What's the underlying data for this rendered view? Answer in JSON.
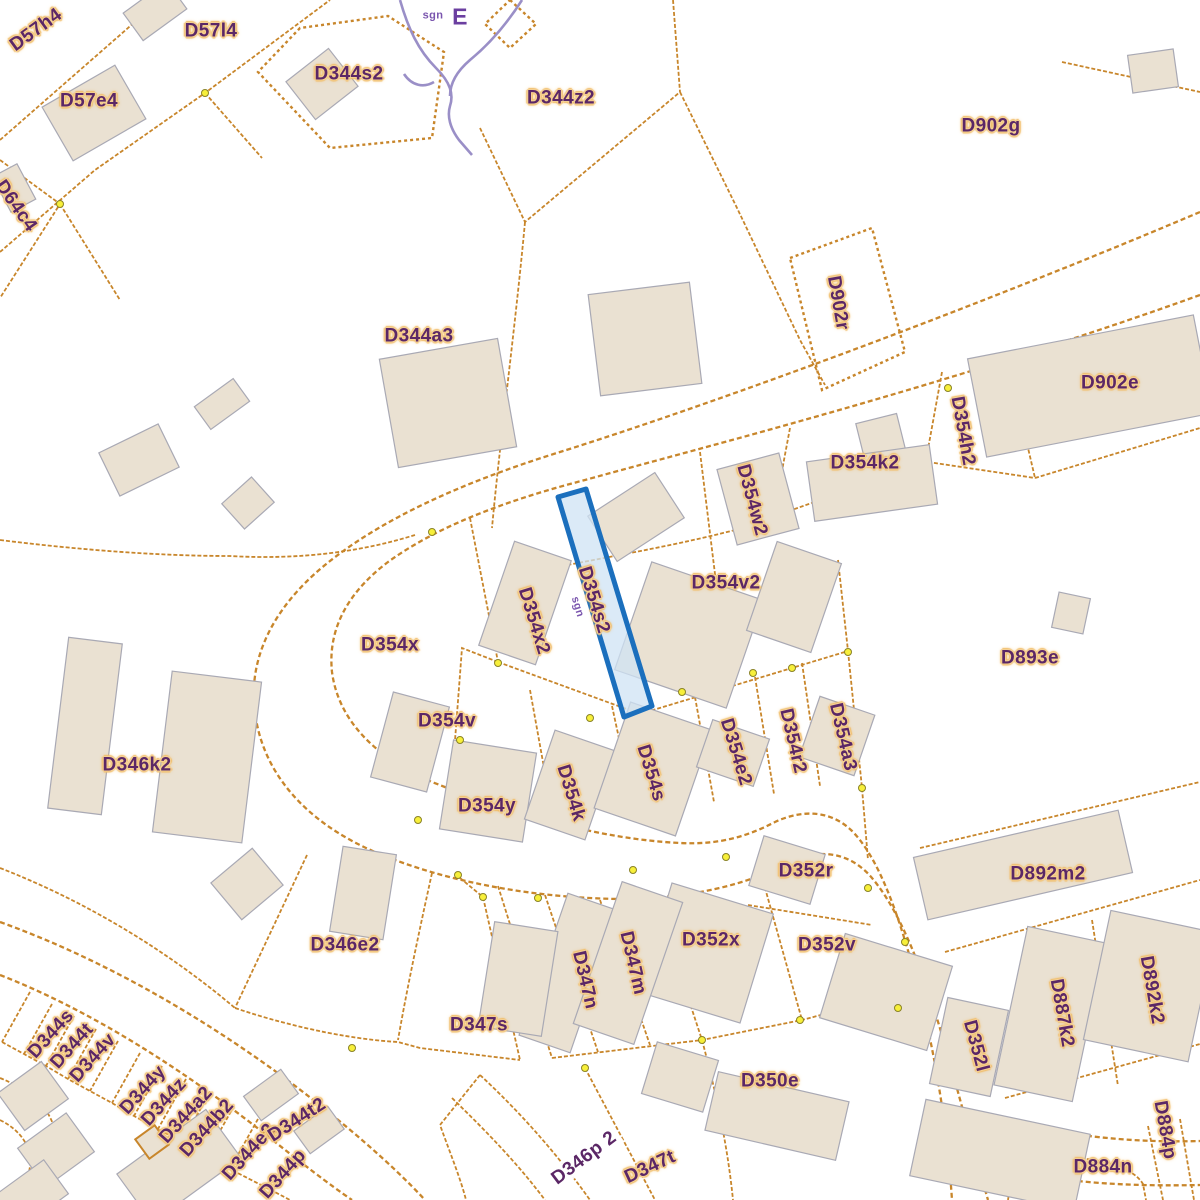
{
  "map": {
    "type": "cadastral-parcel-map",
    "highlighted_parcel": "D354s2",
    "colors": {
      "background": "#ffffff",
      "parcel_line": "#c8862b",
      "building_fill": "#eae1d2",
      "building_stroke": "#a9a9b4",
      "label_text": "#5b2766",
      "label_halo": "#f1bd68",
      "highlight_fill": "#cfe3f4",
      "highlight_stroke": "#1b6fbd",
      "stream": "#9a8fc7",
      "marker_fill": "#f7ef3a",
      "marker_stroke": "#8a8326"
    },
    "labels": [
      {
        "text": "D57h4",
        "x": 36,
        "y": 30,
        "rot": -36,
        "style": "parcel"
      },
      {
        "text": "D57l4",
        "x": 211,
        "y": 31,
        "rot": 0,
        "style": "parcel"
      },
      {
        "text": "D344s2",
        "x": 349,
        "y": 74,
        "rot": 0,
        "style": "parcel"
      },
      {
        "text": "D344z2",
        "x": 561,
        "y": 98,
        "rot": 0,
        "style": "parcel"
      },
      {
        "text": "D902g",
        "x": 991,
        "y": 126,
        "rot": 0,
        "style": "parcel"
      },
      {
        "text": "D57e4",
        "x": 89,
        "y": 101,
        "rot": 0,
        "style": "parcel"
      },
      {
        "text": "D64c4",
        "x": 16,
        "y": 206,
        "rot": 55,
        "style": "parcel"
      },
      {
        "text": "E",
        "x": 460,
        "y": 17,
        "rot": 0,
        "style": "purple-large"
      },
      {
        "text": "sgn",
        "x": 433,
        "y": 16,
        "rot": 0,
        "style": "purple-small"
      },
      {
        "text": "D902r",
        "x": 838,
        "y": 303,
        "rot": 80,
        "style": "parcel"
      },
      {
        "text": "D344a3",
        "x": 419,
        "y": 336,
        "rot": 0,
        "style": "parcel"
      },
      {
        "text": "D902e",
        "x": 1110,
        "y": 383,
        "rot": 0,
        "style": "parcel"
      },
      {
        "text": "D354h2",
        "x": 963,
        "y": 431,
        "rot": 80,
        "style": "parcel"
      },
      {
        "text": "D354k2",
        "x": 865,
        "y": 463,
        "rot": 0,
        "style": "parcel"
      },
      {
        "text": "D354w2",
        "x": 752,
        "y": 500,
        "rot": 75,
        "style": "parcel"
      },
      {
        "text": "D354v2",
        "x": 726,
        "y": 583,
        "rot": 0,
        "style": "parcel"
      },
      {
        "text": "D354x2",
        "x": 534,
        "y": 621,
        "rot": 73,
        "style": "parcel"
      },
      {
        "text": "sgn",
        "x": 577,
        "y": 607,
        "rot": 73,
        "style": "purple-small"
      },
      {
        "text": "D354s2",
        "x": 594,
        "y": 600,
        "rot": 73,
        "style": "parcel"
      },
      {
        "text": "D354x",
        "x": 390,
        "y": 645,
        "rot": 0,
        "style": "parcel"
      },
      {
        "text": "D893e",
        "x": 1030,
        "y": 658,
        "rot": 0,
        "style": "parcel"
      },
      {
        "text": "D354v",
        "x": 447,
        "y": 721,
        "rot": 0,
        "style": "parcel"
      },
      {
        "text": "D346k2",
        "x": 137,
        "y": 765,
        "rot": 0,
        "style": "parcel"
      },
      {
        "text": "D354e2",
        "x": 736,
        "y": 752,
        "rot": 73,
        "style": "parcel"
      },
      {
        "text": "D354r2",
        "x": 793,
        "y": 741,
        "rot": 77,
        "style": "parcel"
      },
      {
        "text": "D354a3",
        "x": 843,
        "y": 737,
        "rot": 77,
        "style": "parcel"
      },
      {
        "text": "D354s",
        "x": 651,
        "y": 773,
        "rot": 73,
        "style": "parcel"
      },
      {
        "text": "D354k",
        "x": 571,
        "y": 793,
        "rot": 73,
        "style": "parcel"
      },
      {
        "text": "D354y",
        "x": 487,
        "y": 806,
        "rot": 0,
        "style": "parcel"
      },
      {
        "text": "D352r",
        "x": 806,
        "y": 871,
        "rot": 0,
        "style": "parcel"
      },
      {
        "text": "D892m2",
        "x": 1048,
        "y": 874,
        "rot": 0,
        "style": "parcel"
      },
      {
        "text": "D346e2",
        "x": 345,
        "y": 945,
        "rot": 0,
        "style": "parcel"
      },
      {
        "text": "D352x",
        "x": 711,
        "y": 940,
        "rot": 0,
        "style": "parcel"
      },
      {
        "text": "D352v",
        "x": 827,
        "y": 945,
        "rot": 0,
        "style": "parcel"
      },
      {
        "text": "D347m",
        "x": 633,
        "y": 963,
        "rot": 77,
        "style": "parcel"
      },
      {
        "text": "D347n",
        "x": 585,
        "y": 980,
        "rot": 77,
        "style": "parcel"
      },
      {
        "text": "D347s",
        "x": 479,
        "y": 1025,
        "rot": 0,
        "style": "parcel"
      },
      {
        "text": "D892k2",
        "x": 1152,
        "y": 990,
        "rot": 80,
        "style": "parcel"
      },
      {
        "text": "D887k2",
        "x": 1062,
        "y": 1013,
        "rot": 80,
        "style": "parcel"
      },
      {
        "text": "D352l",
        "x": 976,
        "y": 1046,
        "rot": 75,
        "style": "parcel"
      },
      {
        "text": "D350e",
        "x": 770,
        "y": 1081,
        "rot": 0,
        "style": "parcel"
      },
      {
        "text": "D346p 2",
        "x": 584,
        "y": 1158,
        "rot": -37,
        "style": "white-box"
      },
      {
        "text": "D347t",
        "x": 650,
        "y": 1167,
        "rot": -25,
        "style": "parcel"
      },
      {
        "text": "D884n",
        "x": 1103,
        "y": 1167,
        "rot": 0,
        "style": "parcel"
      },
      {
        "text": "D884p",
        "x": 1165,
        "y": 1130,
        "rot": 80,
        "style": "parcel"
      },
      {
        "text": "D344s",
        "x": 51,
        "y": 1034,
        "rot": -48,
        "style": "parcel"
      },
      {
        "text": "D344t",
        "x": 72,
        "y": 1046,
        "rot": -48,
        "style": "parcel"
      },
      {
        "text": "D344v",
        "x": 93,
        "y": 1058,
        "rot": -48,
        "style": "parcel"
      },
      {
        "text": "D344y",
        "x": 143,
        "y": 1090,
        "rot": -48,
        "style": "parcel"
      },
      {
        "text": "D344z",
        "x": 164,
        "y": 1102,
        "rot": -48,
        "style": "parcel"
      },
      {
        "text": "D344a2",
        "x": 186,
        "y": 1115,
        "rot": -48,
        "style": "parcel"
      },
      {
        "text": "D344b2",
        "x": 207,
        "y": 1128,
        "rot": -48,
        "style": "parcel"
      },
      {
        "text": "D344e2",
        "x": 249,
        "y": 1152,
        "rot": -48,
        "style": "parcel"
      },
      {
        "text": "D344p",
        "x": 283,
        "y": 1174,
        "rot": -48,
        "style": "parcel"
      },
      {
        "text": "D344t2",
        "x": 297,
        "y": 1120,
        "rot": -33,
        "style": "parcel"
      }
    ]
  }
}
